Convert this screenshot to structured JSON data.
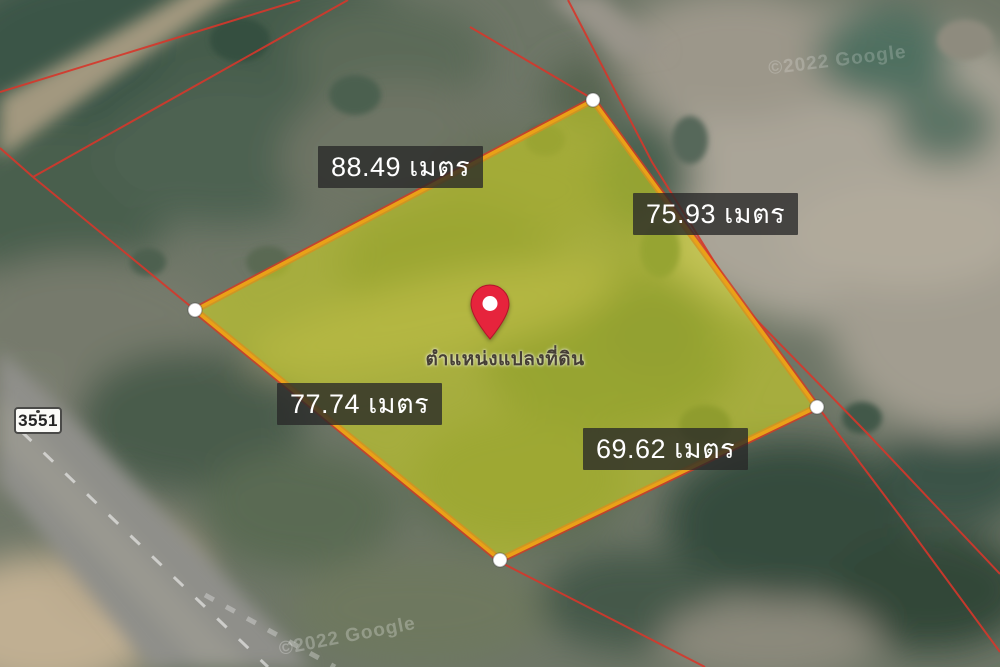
{
  "map": {
    "measurements": [
      {
        "side": "top-left-edge",
        "label": "88.49 เมตร"
      },
      {
        "side": "top-right-edge",
        "label": "75.93 เมตร"
      },
      {
        "side": "bottom-left-edge",
        "label": "77.74 เมตร"
      },
      {
        "side": "bottom-right-edge",
        "label": "69.62 เมตร"
      }
    ],
    "pin_caption": "ตำแหน่งแปลงที่ดิน",
    "route_shield": "3551",
    "watermarks": {
      "top_right": "©2022 Google",
      "bottom": "©2022 Google"
    },
    "colors": {
      "parcel_fill": "#dbe018",
      "parcel_border": "#eaa118",
      "cadastral_red": "#d6372b",
      "pin_red": "#e6243c",
      "label_bg": "rgba(40,40,40,0.78)",
      "label_text": "#ffffff"
    }
  }
}
